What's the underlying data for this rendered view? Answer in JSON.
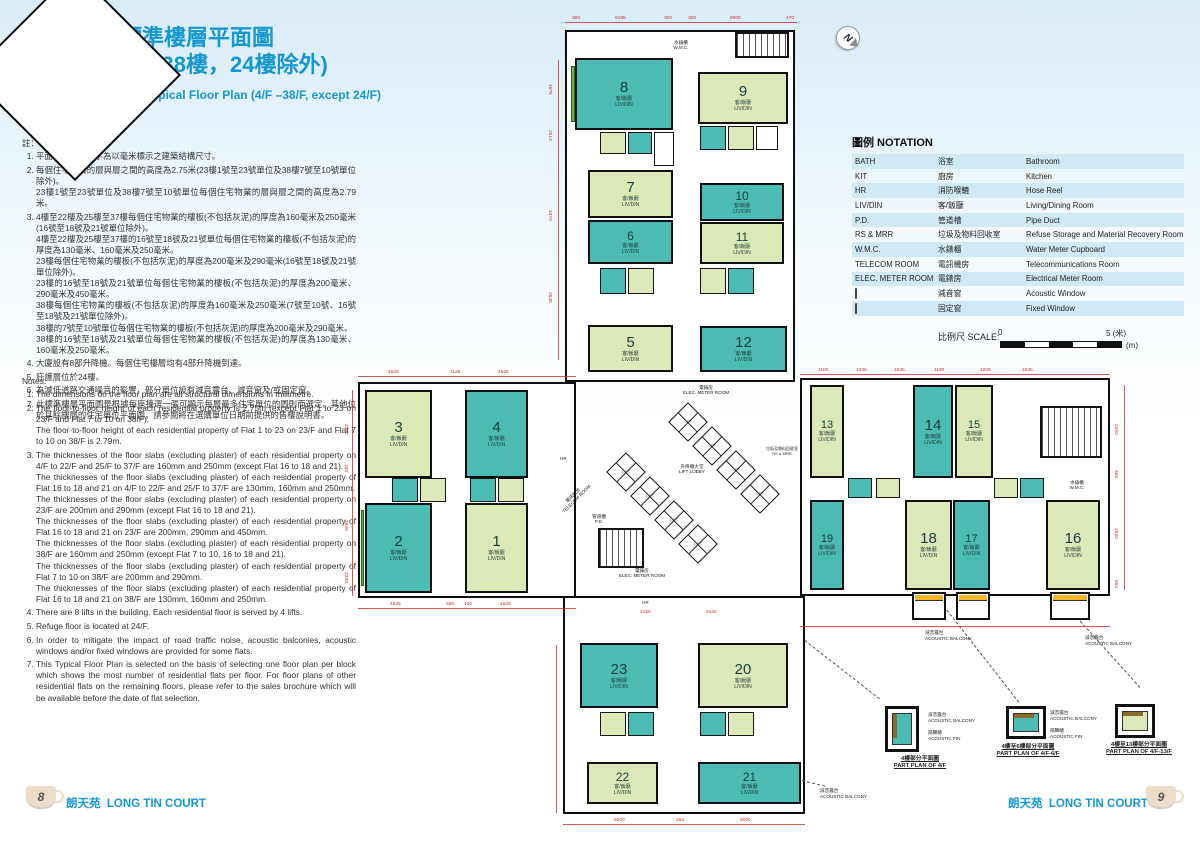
{
  "page": {
    "block_letter": "A",
    "title_zh1": "座標準樓層平面圖",
    "title_zh2": "(4樓至38樓，24樓除外)",
    "title_en": "Block A Typical Floor Plan (4/F –38/F, except 24/F)"
  },
  "notes_zh": {
    "heading": "註：",
    "items": [
      [
        "平面圖所列之數字為以毫米標示之建築結構尺寸。"
      ],
      [
        "每個住宅物業的層與層之間的高度為2.75米(23樓1號至23號單位及38樓7號至10號單位除外)。",
        "23樓1號至23號單位及38樓7號至10號單位每個住宅物業的層與層之間的高度為2.79米。"
      ],
      [
        "4樓至22樓及25樓至37樓每個住宅物業的樓板(不包括灰泥)的厚度為160毫米及250毫米(16號至18號及21號單位除外)。",
        "4樓至22樓及25樓至37樓的16號至18號及21號單位每個住宅物業的樓板(不包括灰泥)的厚度為130毫米、160毫米及250毫米。",
        "23樓每個住宅物業的樓板(不包括灰泥)的厚度為200毫米及290毫米(16號至18號及21號單位除外)。",
        "23樓的16號至18號及21號單位每個住宅物業的樓板(不包括灰泥)的厚度為200毫米、290毫米及450毫米。",
        "38樓每個住宅物業的樓板(不包括灰泥)的厚度為160毫米及250毫米(7號至10號、16號至18號及21號單位除外)。",
        "38樓的7號至10號單位每個住宅物業的樓板(不包括灰泥)的厚度為200毫米及290毫米。",
        "38樓的16號至18號及21號單位每個住宅物業的樓板(不包括灰泥)的厚度為130毫米、160毫米及250毫米。"
      ],
      [
        "大廈設有8部升降機。每個住宅樓層均有4部升降機到達。"
      ],
      [
        "庇護層位於24樓。"
      ],
      [
        "為減低道路交通噪音的影響，部分單位設有減音露台、減音窗及/或固定窗。"
      ],
      [
        "此標準樓層平面圖是根據每座揀選一張可顯示每層最多住宅單位的圖則而選定。其他位於其餘樓層的住宅單位平面圖，請參閱將在選購單位日期前提供的售樓說明書。"
      ]
    ]
  },
  "notes_en": {
    "heading": "Notes:",
    "items": [
      [
        "The dimensions on the floor plan are all structural dimensions in millimetre."
      ],
      [
        "The floor-to-floor height of each residential property is 2.75m (except Flat 1 to 23 on 23/F and Flat 7 to 10 on 38/F).",
        "The floor-to-floor height of each residential property of Flat 1 to 23 on 23/F and Flat 7 to 10 on 38/F is 2.79m."
      ],
      [
        "The thicknesses of the floor slabs (excluding plaster) of each residential property on 4/F to 22/F and 25/F to 37/F are 160mm and 250mm (except Flat 16 to 18 and 21).",
        "The thicknesses of the floor slabs (excluding plaster) of each residential property of Flat 16 to 18 and 21 on 4/F to 22/F and 25/F to 37/F are 130mm, 160mm and 250mm.",
        "The thicknesses of the floor slabs (excluding plaster) of each residential property on 23/F are 200mm and 290mm (except Flat 16 to 18 and 21).",
        "The thicknesses of the floor slabs (excluding plaster) of each residential property of Flat 16 to 18 and 21 on 23/F are 200mm, 290mm and 450mm.",
        "The thicknesses of the floor slabs (excluding plaster) of each residential property on 38/F are 160mm and 250mm (except Flat 7 to 10, 16 to 18 and 21).",
        "The thicknesses of the floor slabs (excluding plaster) of each residential property of Flat 7 to 10 on 38/F are 200mm and 290mm.",
        "The thicknesses of the floor slabs (excluding plaster) of each residential property of Flat 16 to 18 and 21 on 38/F are 130mm, 160mm and 250mm."
      ],
      [
        "There are 8 lifts in the building. Each residential floor is served by 4 lifts."
      ],
      [
        "Refuge floor is located at 24/F."
      ],
      [
        "In order to mitigate the impact of road traffic noise, acoustic balconies, acoustic windows and/or fixed windows are provided for some flats."
      ],
      [
        "This Typical Floor Plan is selected on the basis of selecting one floor plan per block which shows the most number of residential flats per floor. For floor plans of other residential flats on the remaining floors, please refer to the sales brochure which will be available before the date of flat selection."
      ]
    ]
  },
  "notation": {
    "title": "圖例 NOTATION",
    "rows": [
      {
        "abbr": "BATH",
        "zh": "浴室",
        "en": "Bathroom"
      },
      {
        "abbr": "KIT",
        "zh": "廚房",
        "en": "Kitchen"
      },
      {
        "abbr": "HR",
        "zh": "消防喉轆",
        "en": "Hose Reel"
      },
      {
        "abbr": "LIV/DIN",
        "zh": "客/飯廳",
        "en": "Living/Dining Room"
      },
      {
        "abbr": "P.D.",
        "zh": "管道槽",
        "en": "Pipe Duct"
      },
      {
        "abbr": "RS & MRR",
        "zh": "垃圾及物料回收室",
        "en": "Refuse Storage and Material Recovery Room"
      },
      {
        "abbr": "W.M.C.",
        "zh": "水錶櫃",
        "en": "Water Meter Cupboard"
      },
      {
        "abbr": "TELECOM ROOM",
        "zh": "電訊機房",
        "en": "Telecommunications Room"
      },
      {
        "abbr": "ELEC. METER ROOM",
        "zh": "電錶房",
        "en": "Electrical Meter Room"
      },
      {
        "swatch": "green",
        "abbr": "",
        "zh": "減音窗",
        "en": "Acoustic Window"
      },
      {
        "swatch": "yellow",
        "abbr": "",
        "zh": "固定窗",
        "en": "Fixed Window"
      }
    ]
  },
  "scale": {
    "label": "比例尺 SCALE:",
    "zero": "0",
    "five": "5 (米)",
    "metre": "(m)"
  },
  "north": {
    "letter": "N"
  },
  "plan": {
    "room_zh": "客/飯廳",
    "room_en": "LIV/DIN",
    "core": {
      "lift_lobby_zh": "升降機大堂",
      "lift_lobby_en": "LIFT LOBBY",
      "lift_en": "LIFT",
      "emr_zh": "電錶房",
      "emr_en": "ELEC. METER ROOM",
      "telecom_zh": "電訊機房",
      "telecom_en": "TELECOM ROOM",
      "pd_zh": "管道槽",
      "pd_en": "P.D.",
      "rsmrr_zh": "垃圾及物料回收室",
      "rsmrr_en": "RS & MRR",
      "wmc_zh": "水錶櫃",
      "wmc_en": "W.M.C.",
      "hr": "HR"
    },
    "flats": [
      {
        "num": "1",
        "c": "g",
        "x": 465,
        "y": 503,
        "w": 63,
        "h": 90
      },
      {
        "num": "2",
        "c": "t",
        "x": 365,
        "y": 503,
        "w": 67,
        "h": 90
      },
      {
        "num": "3",
        "c": "g",
        "x": 365,
        "y": 390,
        "w": 67,
        "h": 88
      },
      {
        "num": "4",
        "c": "t",
        "x": 465,
        "y": 390,
        "w": 63,
        "h": 88
      },
      {
        "num": "5",
        "c": "g",
        "x": 588,
        "y": 325,
        "w": 85,
        "h": 47
      },
      {
        "num": "6",
        "c": "t",
        "x": 588,
        "y": 220,
        "w": 85,
        "h": 44
      },
      {
        "num": "7",
        "c": "g",
        "x": 588,
        "y": 170,
        "w": 85,
        "h": 48
      },
      {
        "num": "8",
        "c": "t",
        "x": 575,
        "y": 58,
        "w": 98,
        "h": 72
      },
      {
        "num": "9",
        "c": "g",
        "x": 698,
        "y": 72,
        "w": 90,
        "h": 52
      },
      {
        "num": "10",
        "c": "t",
        "x": 700,
        "y": 183,
        "w": 84,
        "h": 38
      },
      {
        "num": "11",
        "c": "g",
        "x": 700,
        "y": 222,
        "w": 84,
        "h": 42
      },
      {
        "num": "12",
        "c": "t",
        "x": 700,
        "y": 326,
        "w": 87,
        "h": 46
      },
      {
        "num": "13",
        "c": "g",
        "x": 810,
        "y": 385,
        "w": 34,
        "h": 93
      },
      {
        "num": "14",
        "c": "t",
        "x": 913,
        "y": 385,
        "w": 40,
        "h": 93
      },
      {
        "num": "15",
        "c": "g",
        "x": 955,
        "y": 385,
        "w": 38,
        "h": 93
      },
      {
        "num": "16",
        "c": "g",
        "x": 1046,
        "y": 500,
        "w": 54,
        "h": 90
      },
      {
        "num": "17",
        "c": "t",
        "x": 953,
        "y": 500,
        "w": 37,
        "h": 90
      },
      {
        "num": "18",
        "c": "g",
        "x": 905,
        "y": 500,
        "w": 47,
        "h": 90
      },
      {
        "num": "19",
        "c": "t",
        "x": 810,
        "y": 500,
        "w": 34,
        "h": 90
      },
      {
        "num": "20",
        "c": "g",
        "x": 698,
        "y": 643,
        "w": 90,
        "h": 65
      },
      {
        "num": "21",
        "c": "t",
        "x": 698,
        "y": 762,
        "w": 103,
        "h": 42
      },
      {
        "num": "22",
        "c": "g",
        "x": 587,
        "y": 762,
        "w": 71,
        "h": 42
      },
      {
        "num": "23",
        "c": "t",
        "x": 580,
        "y": 643,
        "w": 78,
        "h": 65
      }
    ],
    "lifts": [
      [
        688,
        422
      ],
      [
        712,
        446
      ],
      [
        736,
        470
      ],
      [
        760,
        494
      ],
      [
        626,
        472
      ],
      [
        650,
        496
      ],
      [
        674,
        520
      ],
      [
        698,
        544
      ]
    ],
    "rooms": [
      [
        600,
        132,
        26,
        22,
        "g"
      ],
      [
        628,
        132,
        24,
        22,
        "t"
      ],
      [
        654,
        132,
        20,
        34,
        "w"
      ],
      [
        700,
        126,
        26,
        24,
        "t"
      ],
      [
        728,
        126,
        26,
        24,
        "g"
      ],
      [
        756,
        126,
        22,
        24,
        "w"
      ],
      [
        600,
        268,
        26,
        26,
        "t"
      ],
      [
        628,
        268,
        26,
        26,
        "g"
      ],
      [
        700,
        268,
        26,
        26,
        "g"
      ],
      [
        728,
        268,
        26,
        26,
        "t"
      ],
      [
        392,
        478,
        26,
        24,
        "t"
      ],
      [
        420,
        478,
        26,
        24,
        "g"
      ],
      [
        470,
        478,
        26,
        24,
        "t"
      ],
      [
        498,
        478,
        26,
        24,
        "g"
      ],
      [
        848,
        478,
        24,
        20,
        "t"
      ],
      [
        876,
        478,
        24,
        20,
        "g"
      ],
      [
        994,
        478,
        24,
        20,
        "g"
      ],
      [
        1020,
        478,
        24,
        20,
        "t"
      ],
      [
        600,
        712,
        26,
        24,
        "g"
      ],
      [
        628,
        712,
        26,
        24,
        "t"
      ],
      [
        700,
        712,
        26,
        24,
        "t"
      ],
      [
        728,
        712,
        26,
        24,
        "g"
      ]
    ],
    "stairs": [
      [
        735,
        32,
        54,
        26
      ],
      [
        1040,
        406,
        62,
        52
      ],
      [
        598,
        528,
        46,
        40
      ]
    ],
    "balconies": [
      [
        912,
        592,
        34,
        28
      ],
      [
        956,
        592,
        34,
        28
      ],
      [
        1050,
        592,
        40,
        28
      ]
    ],
    "dims": [
      [
        "300",
        572,
        16,
        0
      ],
      [
        "6185",
        615,
        16,
        0
      ],
      [
        "300",
        664,
        16,
        0
      ],
      [
        "320",
        688,
        16,
        0
      ],
      [
        "6000",
        730,
        16,
        0
      ],
      [
        "470",
        786,
        16,
        0
      ],
      [
        "1675",
        552,
        84,
        1
      ],
      [
        "2510",
        552,
        130,
        1
      ],
      [
        "3470",
        552,
        210,
        1
      ],
      [
        "2535",
        552,
        292,
        1
      ],
      [
        "4525",
        388,
        370,
        0
      ],
      [
        "1125",
        450,
        370,
        0
      ],
      [
        "4525",
        498,
        370,
        0
      ],
      [
        "2350",
        348,
        424,
        1
      ],
      [
        "150",
        348,
        464,
        1
      ],
      [
        "2930",
        348,
        520,
        1
      ],
      [
        "2330",
        348,
        572,
        1
      ],
      [
        "4525",
        390,
        602,
        0
      ],
      [
        "250",
        446,
        602,
        0
      ],
      [
        "100",
        464,
        602,
        0
      ],
      [
        "4525",
        500,
        602,
        0
      ],
      [
        "6000",
        614,
        818,
        0
      ],
      [
        "250",
        676,
        818,
        0
      ],
      [
        "6000",
        740,
        818,
        0
      ],
      [
        "1100",
        818,
        368,
        0
      ],
      [
        "1035",
        856,
        368,
        0
      ],
      [
        "1035",
        894,
        368,
        0
      ],
      [
        "1190",
        934,
        368,
        0
      ],
      [
        "1200",
        980,
        368,
        0
      ],
      [
        "1035",
        1022,
        368,
        0
      ],
      [
        "2250",
        1118,
        424,
        1
      ],
      [
        "450",
        1118,
        470,
        1
      ],
      [
        "2930",
        1118,
        528,
        1
      ],
      [
        "650",
        1118,
        580,
        1
      ],
      [
        "2150",
        640,
        610,
        0
      ],
      [
        "2440",
        706,
        610,
        0
      ]
    ],
    "redlines": [
      [
        565,
        22,
        232,
        1
      ],
      [
        558,
        60,
        1,
        300
      ],
      [
        358,
        376,
        218,
        1
      ],
      [
        352,
        390,
        1,
        206
      ],
      [
        358,
        608,
        218,
        1
      ],
      [
        563,
        824,
        242,
        1
      ],
      [
        800,
        374,
        310,
        1
      ],
      [
        1124,
        385,
        1,
        205
      ],
      [
        800,
        626,
        310,
        1
      ],
      [
        556,
        645,
        1,
        168
      ]
    ]
  },
  "part_plans": [
    {
      "zh": "4樓部分平面圖",
      "en": "PART PLAN OF 4/F"
    },
    {
      "zh": "4樓至6樓部分平面圖",
      "en": "PART PLAN OF 4/F-6/F"
    },
    {
      "zh": "4樓至13樓部分平面圖",
      "en": "PART PLAN OF 4/F-13/F"
    }
  ],
  "annotations": {
    "acoustic_balcony_zh": "減音露台",
    "acoustic_balcony_en": "ACOUSTIC BALCONY",
    "acoustic_fin_zh": "隔聲鰭",
    "acoustic_fin_en": "ACOUSTIC FIN"
  },
  "footer": {
    "page_left": "8",
    "page_right": "9",
    "name_zh": "朗天苑",
    "name_en": "LONG TIN COURT"
  }
}
